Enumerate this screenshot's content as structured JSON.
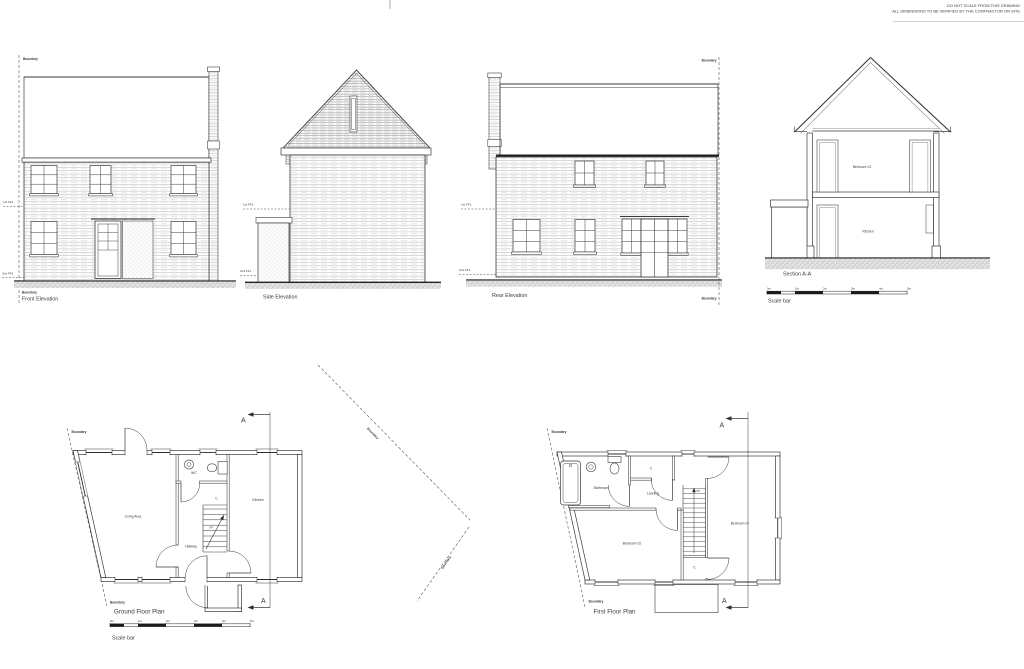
{
  "sheet_notes": {
    "line1": "DO NOT SCALE FROM THIS DRAWING",
    "line2": "ALL DIMENSIONS TO BE VERIFIED BY THE CONTRACTOR ON SITE"
  },
  "labels": {
    "boundary": "Boundary",
    "ffl_first": "1st FFL",
    "ffl_ground": "Grd FFL",
    "section_marker": "A",
    "up": "UP"
  },
  "elevations": {
    "front": {
      "title": "Front Elevation"
    },
    "side": {
      "title": "Side Elevation"
    },
    "rear": {
      "title": "Rear Elevation"
    },
    "section": {
      "title": "Section A-A",
      "room_upper": "Bedroom 01",
      "room_lower": "Kitchen"
    }
  },
  "plans": {
    "ground": {
      "title": "Ground Floor Plan",
      "rooms": {
        "living": "Living Area",
        "wc": "WC",
        "cupboard": "C",
        "kitchen": "Kitchen",
        "hallway": "Hallway"
      }
    },
    "first": {
      "title": "First Floor Plan",
      "rooms": {
        "bathroom": "Bathroom",
        "cupboard_top": "C",
        "landing": "Landing",
        "bedroom_01": "Bedroom 01",
        "bedroom_02": "Bedroom 02",
        "cupboard_bottom": "C"
      }
    }
  },
  "scale_bar": {
    "label": "Scale bar",
    "ticks": [
      "0m",
      "1m",
      "2m",
      "3m",
      "4m",
      "5m"
    ]
  }
}
